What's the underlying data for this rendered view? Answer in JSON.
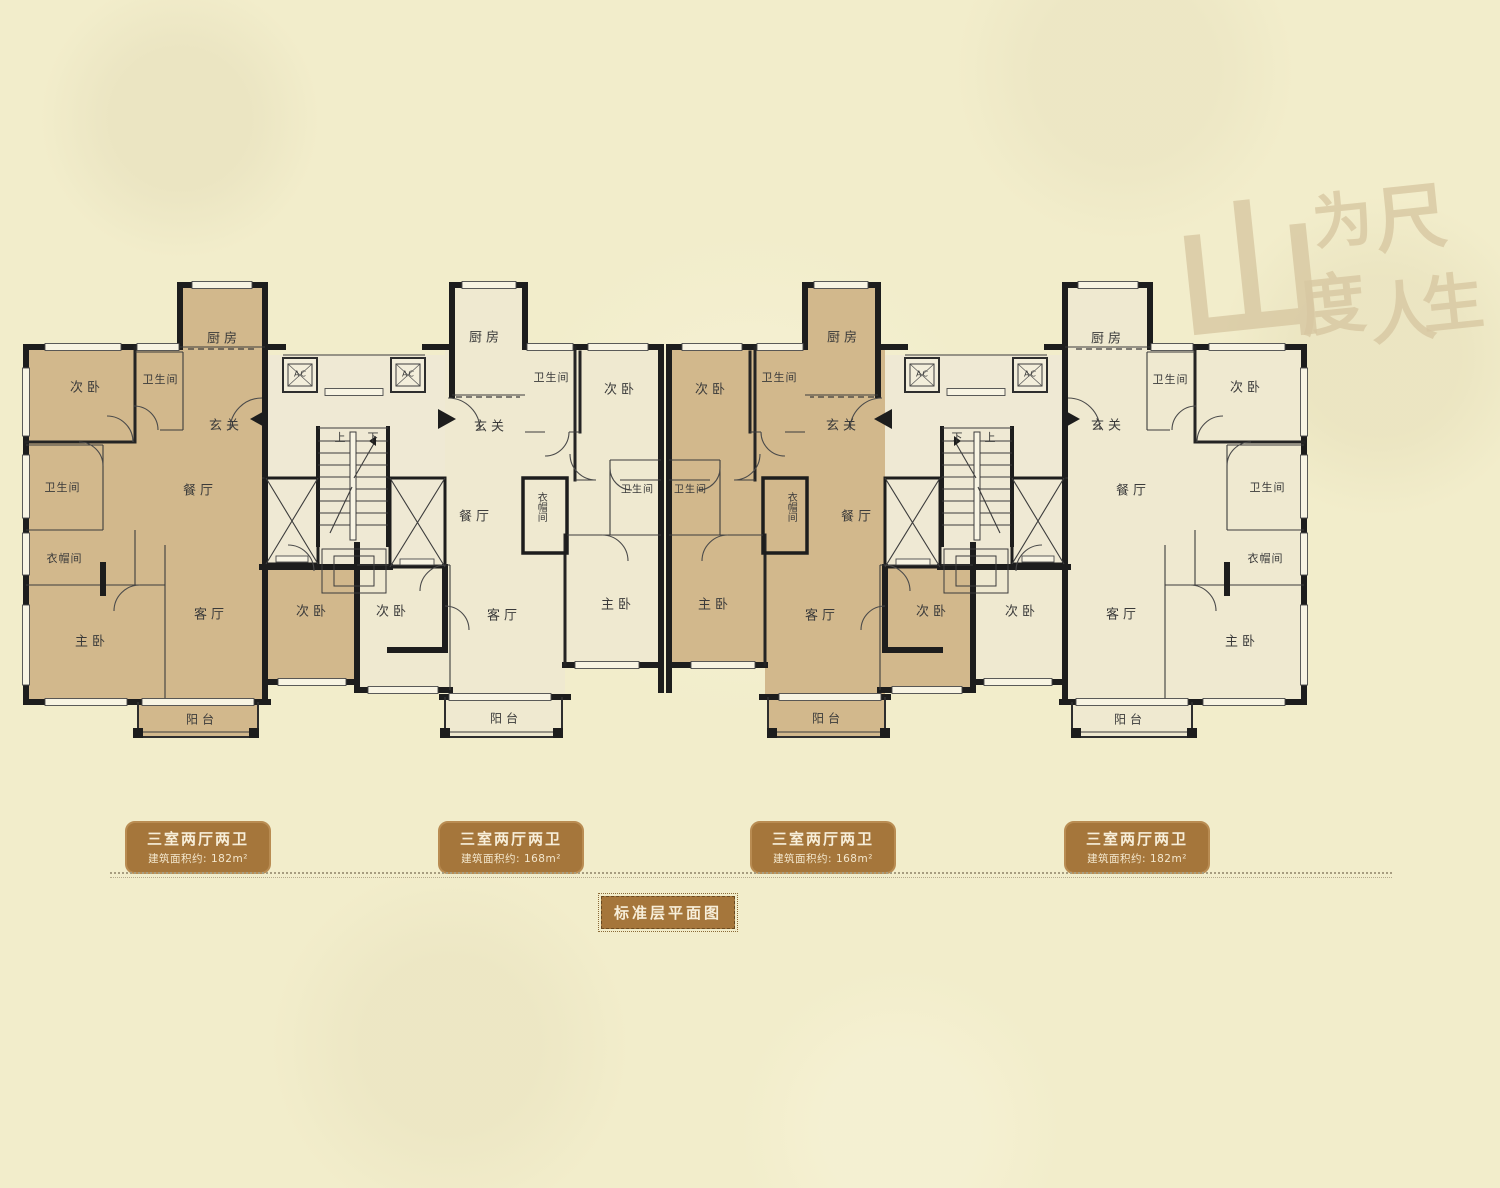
{
  "watermark": {
    "chars": [
      {
        "t": "山",
        "x": 1248,
        "y": 262,
        "s": 150
      },
      {
        "t": "为",
        "x": 1342,
        "y": 216,
        "s": 60
      },
      {
        "t": "尺",
        "x": 1410,
        "y": 212,
        "s": 72
      },
      {
        "t": "度",
        "x": 1332,
        "y": 300,
        "s": 66
      },
      {
        "t": "人",
        "x": 1402,
        "y": 308,
        "s": 66
      },
      {
        "t": "生",
        "x": 1452,
        "y": 298,
        "s": 62
      }
    ]
  },
  "plan": {
    "room_labels": [
      {
        "t": "次卧",
        "x": 85,
        "y": 386
      },
      {
        "t": "卫生间",
        "x": 160,
        "y": 379,
        "s": 11
      },
      {
        "t": "厨房",
        "x": 222,
        "y": 337
      },
      {
        "t": "玄关",
        "x": 224,
        "y": 424
      },
      {
        "t": "餐厅",
        "x": 198,
        "y": 489
      },
      {
        "t": "卫生间",
        "x": 62,
        "y": 487,
        "s": 11
      },
      {
        "t": "衣帽间",
        "x": 64,
        "y": 558,
        "s": 11
      },
      {
        "t": "主卧",
        "x": 90,
        "y": 640
      },
      {
        "t": "客厅",
        "x": 209,
        "y": 613
      },
      {
        "t": "次卧",
        "x": 311,
        "y": 610
      },
      {
        "t": "阳台",
        "x": 200,
        "y": 719,
        "s": 12
      },
      {
        "t": "上",
        "x": 340,
        "y": 437,
        "s": 11
      },
      {
        "t": "下",
        "x": 373,
        "y": 437,
        "s": 11
      },
      {
        "t": "AC",
        "x": 300,
        "y": 374,
        "s": 8
      },
      {
        "t": "AC",
        "x": 408,
        "y": 374,
        "s": 8
      },
      {
        "t": "次卧",
        "x": 391,
        "y": 610
      },
      {
        "t": "厨房",
        "x": 484,
        "y": 336
      },
      {
        "t": "卫生间",
        "x": 551,
        "y": 377,
        "s": 11
      },
      {
        "t": "玄关",
        "x": 489,
        "y": 425
      },
      {
        "t": "次卧",
        "x": 619,
        "y": 388
      },
      {
        "t": "餐厅",
        "x": 474,
        "y": 515
      },
      {
        "t": "衣帽间",
        "x": 540,
        "y": 507,
        "s": 10,
        "v": 1
      },
      {
        "t": "卫生间",
        "x": 637,
        "y": 488,
        "s": 10
      },
      {
        "t": "客厅",
        "x": 502,
        "y": 614
      },
      {
        "t": "主卧",
        "x": 616,
        "y": 603
      },
      {
        "t": "阳台",
        "x": 504,
        "y": 718,
        "s": 12
      },
      {
        "t": "下",
        "x": 957,
        "y": 437,
        "s": 11
      },
      {
        "t": "上",
        "x": 990,
        "y": 437,
        "s": 11
      },
      {
        "t": "AC",
        "x": 922,
        "y": 374,
        "s": 8
      },
      {
        "t": "AC",
        "x": 1030,
        "y": 374,
        "s": 8
      },
      {
        "t": "次卧",
        "x": 710,
        "y": 388
      },
      {
        "t": "卫生间",
        "x": 779,
        "y": 377,
        "s": 11
      },
      {
        "t": "厨房",
        "x": 842,
        "y": 336
      },
      {
        "t": "玄关",
        "x": 841,
        "y": 424
      },
      {
        "t": "餐厅",
        "x": 856,
        "y": 515
      },
      {
        "t": "衣帽间",
        "x": 790,
        "y": 507,
        "s": 10,
        "v": 1
      },
      {
        "t": "卫生间",
        "x": 690,
        "y": 488,
        "s": 10
      },
      {
        "t": "客厅",
        "x": 820,
        "y": 614
      },
      {
        "t": "主卧",
        "x": 713,
        "y": 603
      },
      {
        "t": "次卧",
        "x": 931,
        "y": 610
      },
      {
        "t": "阳台",
        "x": 826,
        "y": 718,
        "s": 12
      },
      {
        "t": "厨房",
        "x": 1106,
        "y": 337
      },
      {
        "t": "卫生间",
        "x": 1170,
        "y": 379,
        "s": 11
      },
      {
        "t": "玄关",
        "x": 1106,
        "y": 424
      },
      {
        "t": "次卧",
        "x": 1245,
        "y": 386
      },
      {
        "t": "餐厅",
        "x": 1131,
        "y": 489
      },
      {
        "t": "卫生间",
        "x": 1267,
        "y": 487,
        "s": 11
      },
      {
        "t": "衣帽间",
        "x": 1265,
        "y": 558,
        "s": 11
      },
      {
        "t": "主卧",
        "x": 1240,
        "y": 640
      },
      {
        "t": "客厅",
        "x": 1121,
        "y": 613
      },
      {
        "t": "次卧",
        "x": 1020,
        "y": 610
      },
      {
        "t": "阳台",
        "x": 1128,
        "y": 719,
        "s": 12
      }
    ]
  },
  "legend": {
    "items": [
      {
        "type": "三室两厅两卫",
        "area": "建筑面积约: 182m²"
      },
      {
        "type": "三室两厅两卫",
        "area": "建筑面积约: 168m²"
      },
      {
        "type": "三室两厅两卫",
        "area": "建筑面积约: 168m²"
      },
      {
        "type": "三室两厅两卫",
        "area": "建筑面积约: 182m²"
      }
    ],
    "title": "标准层平面图"
  },
  "colors": {
    "tan": "#d2b88c",
    "cream": "#efe9d0",
    "core": "#efe9d4",
    "wall": "#1d1d1d",
    "brown": "#a5763b",
    "bg": "#f2edcb",
    "wmcol": "#d8c8a2",
    "ink": "#3a3a3a"
  }
}
